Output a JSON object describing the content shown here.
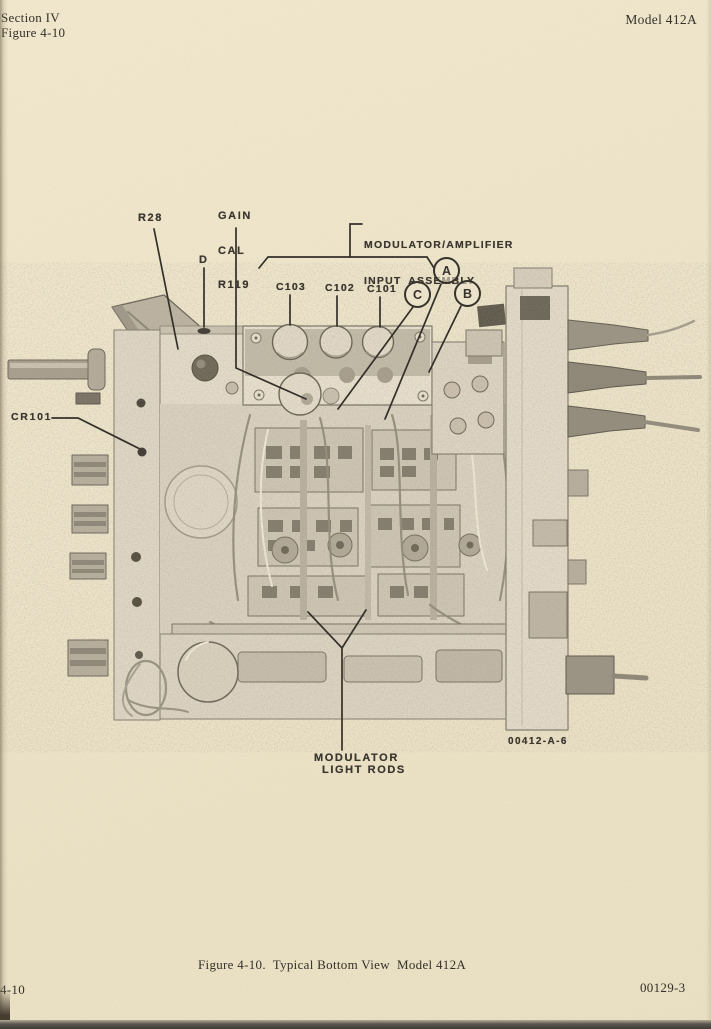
{
  "header": {
    "section": "Section IV",
    "figure_ref": "Figure 4-10",
    "model": "Model 412A"
  },
  "callouts": {
    "r28": "R28",
    "gain_cal_lines": [
      "GAIN",
      "CAL",
      "R119"
    ],
    "d": "D",
    "assembly_lines": [
      "MODULATOR/AMPLIFIER",
      "INPUT ASSEMBLY"
    ],
    "c103": "C103",
    "c102": "C102",
    "c101": "C101",
    "circle_a": "A",
    "circle_b": "B",
    "circle_c": "C",
    "cr101": "CR101",
    "light_rods_lines": [
      "MODULATOR",
      "LIGHT RODS"
    ],
    "photo_id": "00412-A-6"
  },
  "caption": "Figure 4-10.  Typical Bottom View  Model 412A",
  "footer": {
    "page_number": "4-10",
    "doc_number": "00129-3"
  },
  "colors": {
    "paper": "#ece3c8",
    "ink": "#34302a",
    "stamp_ink": "#3b372f"
  }
}
